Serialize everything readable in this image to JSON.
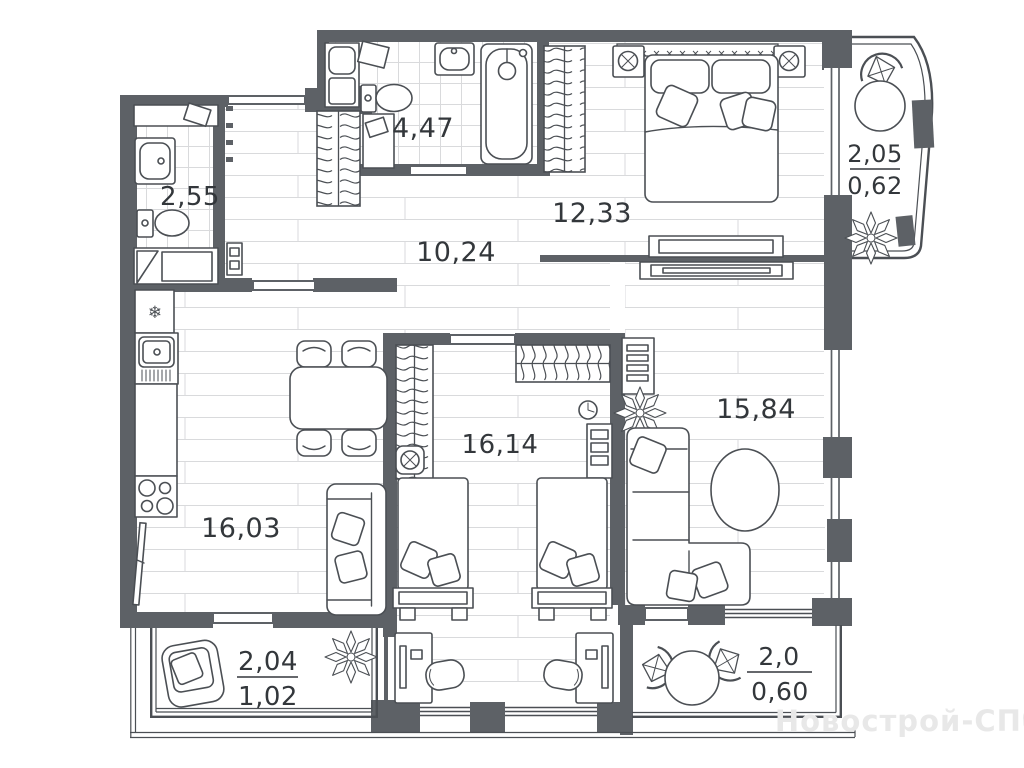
{
  "plan": {
    "watermark": "Новострой-СПб",
    "colors": {
      "wall": "#5d6166",
      "line": "#4b4f54",
      "floor_line": "#d9dadc",
      "label": "#33373b",
      "watermark": "#e8e8e8"
    },
    "icons": {
      "snowflake": "❄"
    },
    "rooms": {
      "wc": {
        "area": "2,55"
      },
      "bathroom": {
        "area": "4,47"
      },
      "hallway": {
        "area": "10,24"
      },
      "bedroom": {
        "area": "12,33"
      },
      "kitchen_living": {
        "area": "16,03"
      },
      "children_room": {
        "area": "16,14"
      },
      "living_room": {
        "area": "15,84"
      },
      "loggia_top_right": {
        "area": "2,05",
        "area_reduced": "0,62"
      },
      "loggia_bottom_left": {
        "area": "2,04",
        "area_reduced": "1,02"
      },
      "loggia_bottom_right": {
        "area": "2,0",
        "area_reduced": "0,60"
      }
    }
  }
}
